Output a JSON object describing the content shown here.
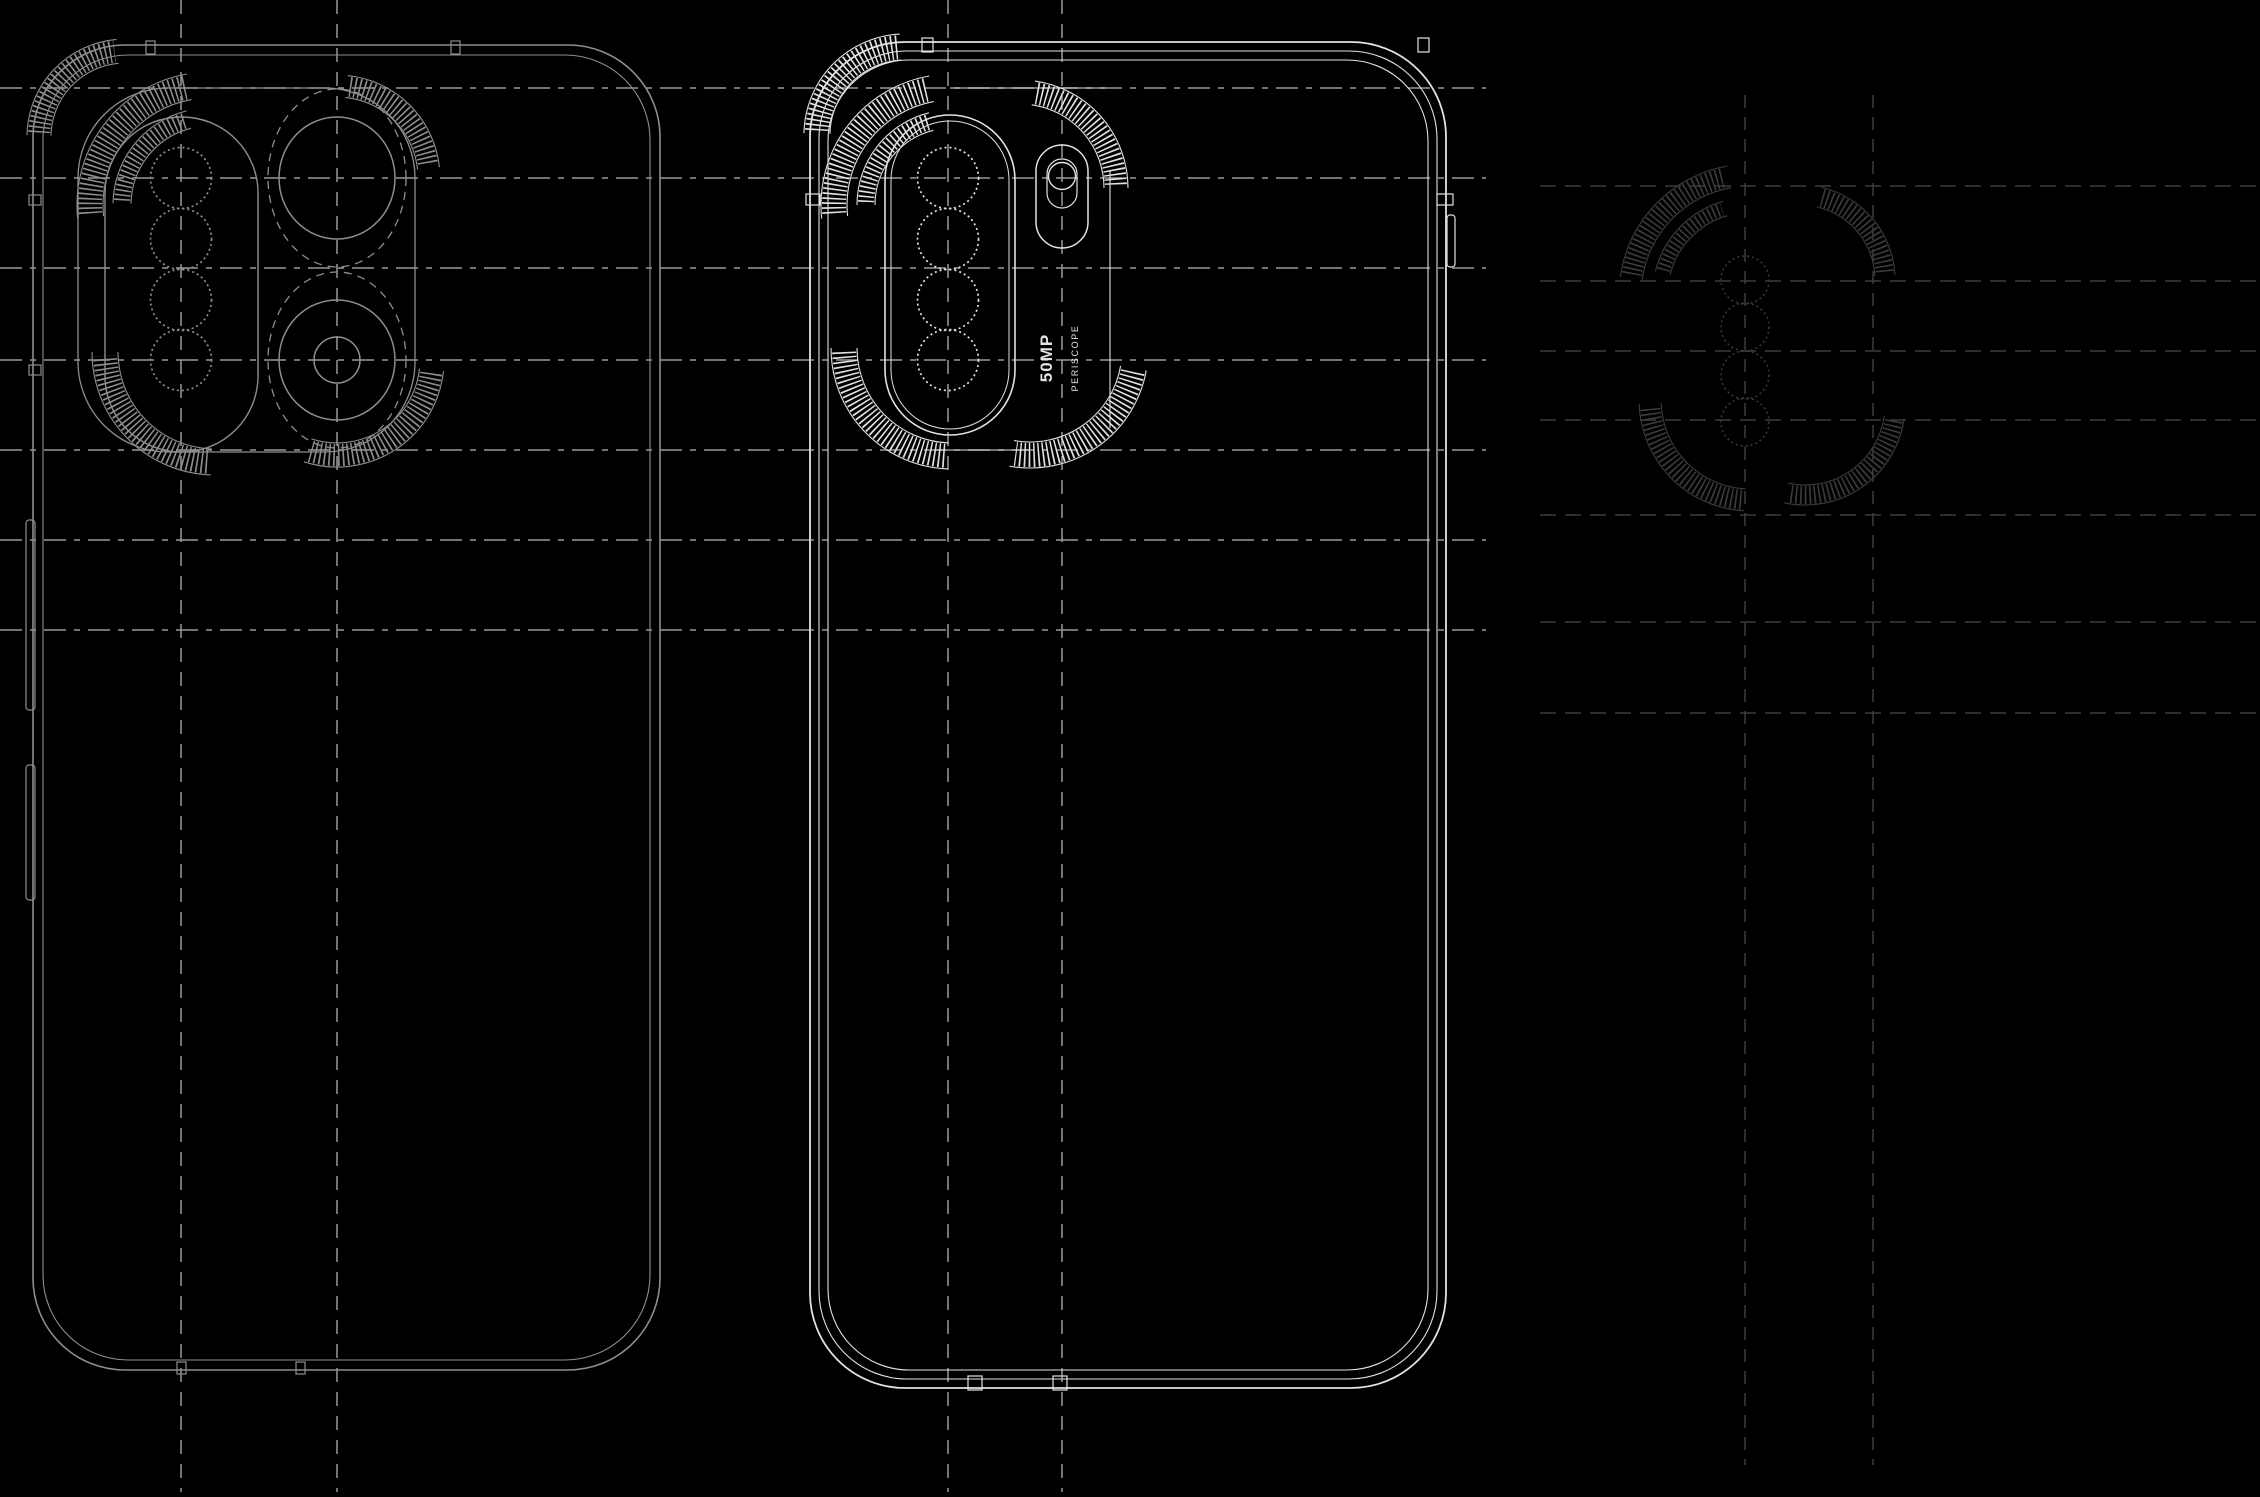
{
  "meta": {
    "description": "Blueprint-style technical line drawing of a smartphone: two rear-view outlines (left gray, center bright) with quad-lens camera modules, flash pill with vertical camera label, hatched corner crescents, and a faint exploded camera-module detail drawing on the right, all over dashed construction guide lines on black.",
    "canvas": {
      "width": 2260,
      "height": 1497
    }
  },
  "colors": {
    "background": "#000000",
    "left_phone": "#8e8e8e",
    "middle_phone": "#e2e2e2",
    "right_detail": "#3c3c3c",
    "guide_main": "#999999",
    "guide_faint": "#3c3c3c"
  },
  "camera_label": {
    "primary": "50MP",
    "secondary": "PERISCOPE"
  },
  "guides": {
    "main": {
      "horizontal_y": [
        88,
        178,
        268,
        360,
        450,
        540,
        630
      ],
      "h_x0": 0,
      "h_x1": 1486,
      "vertical_x": [
        181,
        337,
        948,
        1062
      ],
      "v_y0": 0,
      "v_y1": 1492
    },
    "faint": {
      "horizontal_y": [
        186,
        281,
        351,
        420,
        515,
        622,
        713
      ],
      "h_x0": 1540,
      "h_x1": 2260,
      "vertical_x": [
        1745,
        1873
      ],
      "v_y0": 95,
      "v_y1": 1465
    }
  },
  "left_phone": {
    "outlines": [
      [
        33,
        45,
        627,
        1325,
        92
      ],
      [
        43,
        55,
        607,
        1305,
        85
      ]
    ],
    "top_ticks": [
      150,
      455
    ],
    "bottom_ticks": [
      181,
      300
    ],
    "side_ticks_y": [
      200,
      370
    ],
    "buttons": [
      [
        26,
        520,
        9,
        190
      ],
      [
        26,
        765,
        9,
        135
      ]
    ],
    "module": {
      "outline": [
        78,
        88,
        337,
        364,
        90
      ],
      "lens_pill": [
        105,
        117,
        153,
        335,
        76
      ],
      "lens_circles": {
        "cx": 181,
        "cy": [
          178,
          239,
          300,
          360
        ],
        "r": 30.5
      },
      "big_lenses": [
        {
          "cx": 337,
          "cy": 178,
          "ring_rx": 69,
          "ring_ry": 89,
          "inner_rx": 58,
          "inner_ry": 61,
          "core_r": 0
        },
        {
          "cx": 337,
          "cy": 360,
          "ring_rx": 69,
          "ring_ry": 88,
          "inner_rx": 58,
          "inner_ry": 60,
          "core_r": 23
        }
      ]
    },
    "crescents": [
      [
        125,
        137,
        86,
        183,
        263,
        22
      ],
      [
        210,
        205,
        120,
        176,
        258,
        24
      ],
      [
        210,
        205,
        88,
        183,
        254,
        16
      ],
      [
        337,
        178,
        92,
        278,
        352,
        20
      ],
      [
        215,
        352,
        110,
        94,
        178,
        24
      ],
      [
        337,
        360,
        95,
        8,
        106,
        22
      ]
    ]
  },
  "middle_phone": {
    "outlines": [
      [
        810,
        42,
        636,
        1346,
        95
      ],
      [
        819,
        51,
        618,
        1328,
        88
      ],
      [
        828,
        60,
        600,
        1310,
        81
      ]
    ],
    "top_ticks": [
      927,
      1423
    ],
    "bottom_ports": [
      975,
      1060
    ],
    "left_tick": [
      806,
      194,
      14,
      11
    ],
    "right_notch": [
      1437,
      194,
      16,
      11
    ],
    "right_button": [
      1447,
      215,
      8,
      52
    ],
    "module": {
      "stadium": [
        885,
        115,
        130,
        320,
        65
      ],
      "stadium_inner": [
        891,
        121,
        118,
        308,
        59
      ],
      "lens_circles": {
        "cx": 948,
        "cy": [
          178,
          239,
          300,
          360
        ],
        "r": 30.5
      },
      "flash": {
        "pill": [
          1036,
          145,
          52,
          103,
          26
        ],
        "led_cx": 1062,
        "led_cy": 176,
        "led_r": 13.5,
        "inner_pill": [
          1047,
          159,
          30,
          49,
          15
        ]
      },
      "halo_top_line": [
        950,
        88,
        1105,
        88
      ],
      "halo_right_line": [
        1110,
        170,
        1110,
        428
      ],
      "halo_bottom_line": [
        935,
        450,
        1030,
        450
      ]
    },
    "crescents": [
      [
        905,
        135,
        88,
        183,
        265,
        24
      ],
      [
        952,
        205,
        118,
        176,
        258,
        24
      ],
      [
        952,
        205,
        86,
        182,
        254,
        16
      ],
      [
        1020,
        188,
        96,
        280,
        358,
        22
      ],
      [
        952,
        348,
        108,
        94,
        178,
        24
      ],
      [
        1030,
        350,
        105,
        12,
        98,
        24
      ]
    ]
  },
  "right_detail": {
    "lens_circles": {
      "cx": 1745,
      "cy": [
        280,
        327,
        375,
        422
      ],
      "r": 24
    },
    "crescents": [
      [
        1750,
        295,
        120,
        190,
        258,
        20
      ],
      [
        1750,
        295,
        90,
        196,
        252,
        13
      ],
      [
        1800,
        280,
        85,
        285,
        355,
        18
      ],
      [
        1750,
        400,
        100,
        95,
        176,
        20
      ],
      [
        1805,
        405,
        90,
        10,
        100,
        18
      ]
    ]
  }
}
